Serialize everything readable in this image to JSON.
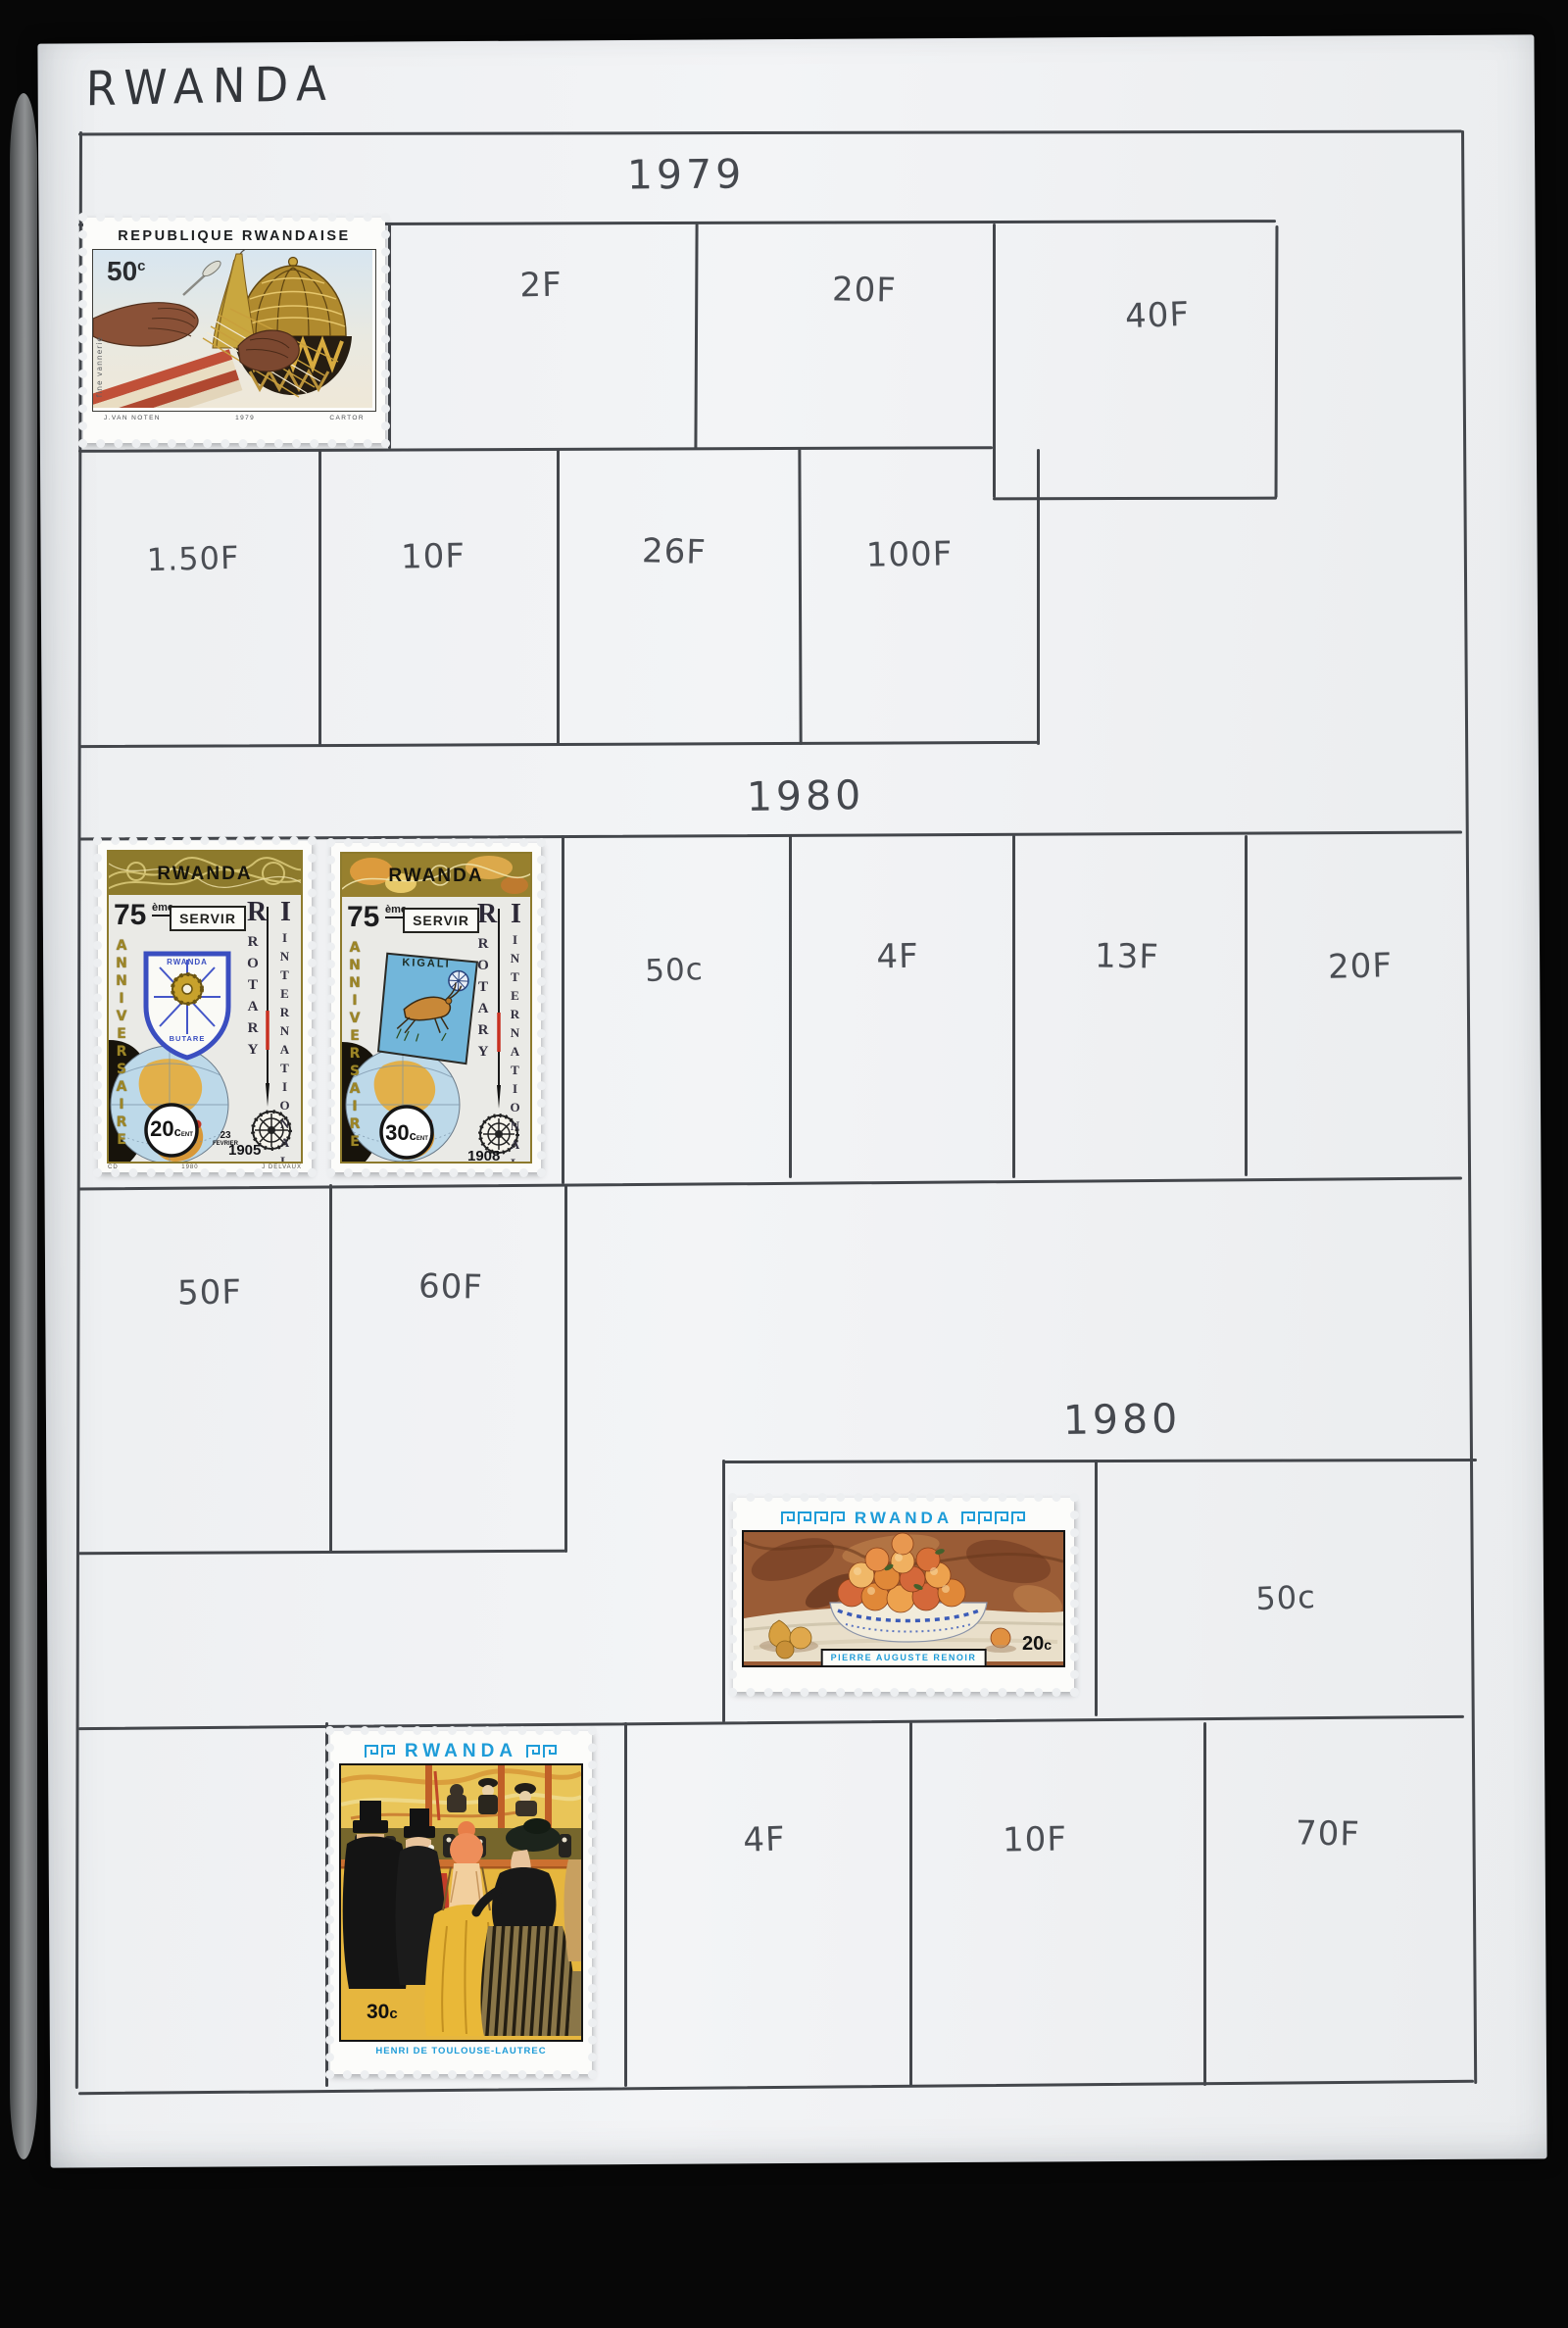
{
  "album": {
    "country": "RWANDA",
    "year_1979": "1979",
    "year_1980_first": "1980",
    "year_1980_second": "1980",
    "row1_values": [
      "2F",
      "20F",
      "40F"
    ],
    "row2_values": [
      "1.50F",
      "10F",
      "26F",
      "100F"
    ],
    "rotary_row_values": [
      "50c",
      "4F",
      "13F",
      "20F"
    ],
    "franc_row_values": [
      "50F",
      "60F"
    ],
    "renoir_row_value": "50c",
    "bottom_row_values": [
      "4F",
      "10F",
      "70F"
    ]
  },
  "stamps": {
    "vannerie": {
      "header": "REPUBLIQUE RWANDAISE",
      "value": "50",
      "unit": "c",
      "side_label": "fine vannerie",
      "credit_designer": "J.VAN NOTEN",
      "credit_year": "1979",
      "credit_printer": "CARTOR"
    },
    "rotary_20": {
      "header": "RWANDA",
      "anniversary_number": "75",
      "anniversary_suffix": "ème",
      "banner": "SERVIR",
      "left_vertical": "ANNIVERSAIRE",
      "initial_r": "R",
      "initial_i": "I",
      "vertical_rotary": "ROTARY",
      "vertical_international": "INTERNATIONAL",
      "shield_top": "RWANDA",
      "shield_bottom": "BUTARE",
      "value": "20",
      "unit": "c",
      "unit_suffix": "ENT",
      "date_day": "23",
      "date_month": "FEVRIER",
      "date_year": "1905",
      "credit_left": "CD",
      "credit_center": "1980",
      "credit_right": "J DELVAUX"
    },
    "rotary_30": {
      "header": "RWANDA",
      "anniversary_number": "75",
      "anniversary_suffix": "ème",
      "banner": "SERVIR",
      "left_vertical": "ANNIVERSAIRE",
      "initial_r": "R",
      "initial_i": "I",
      "vertical_rotary": "ROTARY",
      "vertical_international": "INTERNATIONAL",
      "panel_label": "KIGALI",
      "value": "30",
      "unit": "c",
      "unit_suffix": "ENT",
      "date_year": "1908"
    },
    "renoir": {
      "header": "RWANDA",
      "value": "20",
      "unit": "c",
      "artist": "PIERRE AUGUSTE RENOIR"
    },
    "lautrec": {
      "header": "RWANDA",
      "value": "30",
      "unit": "c",
      "artist": "HENRI DE TOULOUSE-LAUTREC"
    }
  },
  "colors": {
    "page": "#eef0f2",
    "grid_line": "#43464b",
    "handwriting": "#4b4e54",
    "stamp_blue": "#1e9cd8",
    "rotary_gold": "#8d7a2c"
  }
}
